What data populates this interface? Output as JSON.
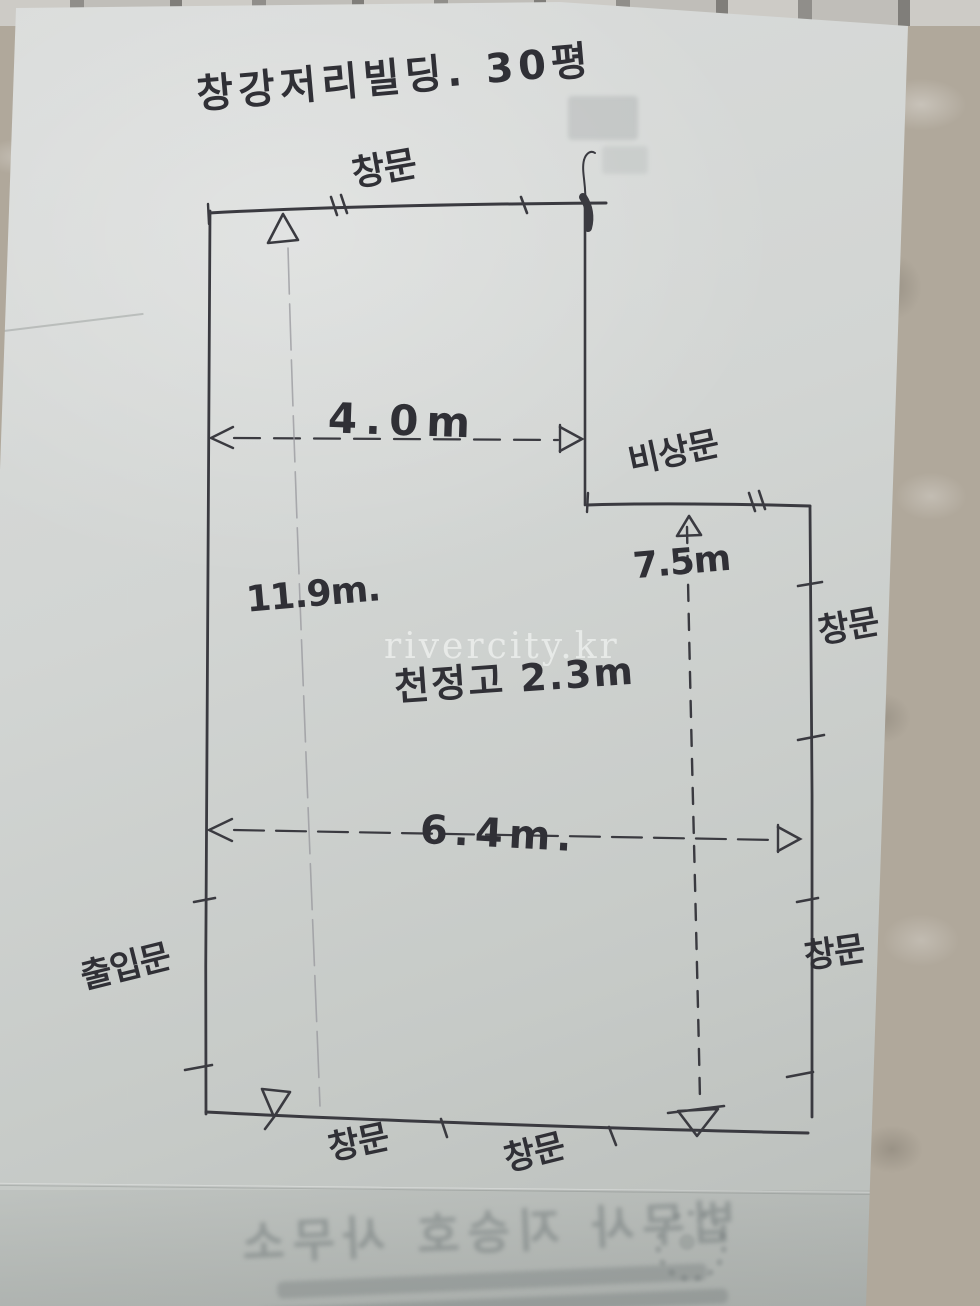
{
  "photo": {
    "title_note": "창강저리빌딩. 30평",
    "watermark": "rivercity.kr"
  },
  "plan": {
    "labels": {
      "window_top": "창문",
      "emergency_door": "비상문",
      "window_right_upper": "창문",
      "window_right_lower": "창문",
      "entrance_door": "출입문",
      "window_bottom_left": "창문",
      "window_bottom_right": "창문"
    },
    "dimensions": {
      "top_width": "4.0m",
      "annex_width": "7.5m",
      "left_height": "11.9m.",
      "middle_width": "6.4m.",
      "ceiling_height_note": "천정고 2.3m"
    }
  },
  "bleed_through": {
    "office_line": "법무사 지승호 사무소"
  },
  "colors": {
    "ink": "#3a3a40",
    "pencil": "#97979c",
    "paper": "#d2d5d3",
    "floor": "#b0a89b",
    "watermark_text": "#f7f9f7"
  }
}
